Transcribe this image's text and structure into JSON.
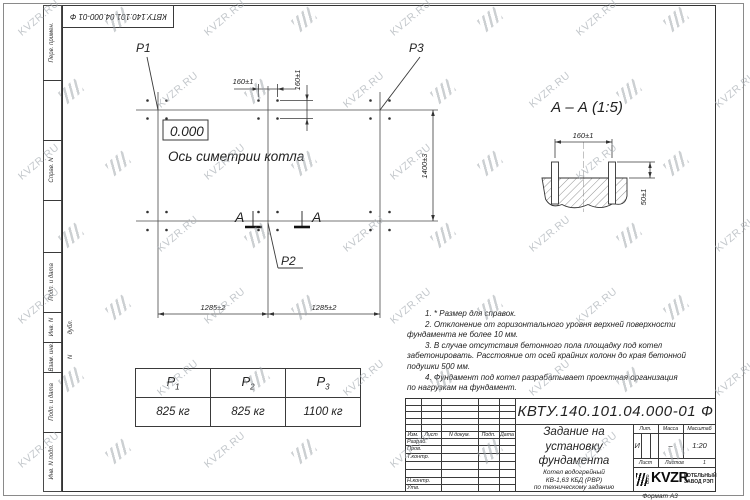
{
  "watermark": {
    "text": "KVZR.RU",
    "color": "#aab0b6"
  },
  "frame": {
    "top_stamp": "КВТУ.140.101.04.000-01 Ф",
    "format_label": "Формат А3",
    "margin_labels": [
      "Перв. примен.",
      "Справ. N",
      "Подп. и дата",
      "Инв. N дубл.",
      "Взам. инв. N",
      "Подп. и дата",
      "Инв. N подл."
    ]
  },
  "plan": {
    "label_p1": "P1",
    "label_p2": "P2",
    "label_p3": "P3",
    "elevation": "0.000",
    "axis_label": "Ось симетрии котла",
    "section_letter_left": "А",
    "section_letter_right": "А",
    "dim_bolt_h": "160±1",
    "dim_bolt_v": "160±1",
    "dim_width": "1400±3",
    "dim_span_left": "1285±2",
    "dim_span_right": "1285±2"
  },
  "section_view": {
    "title": "А – А (1:5)",
    "dim_bolts": "160±1",
    "dim_height": "50±1"
  },
  "notes": {
    "line1": "1. * Размер для справок.",
    "line2": "2. Отклонение от горизонтального уровня верхней поверхности",
    "line3": "фундамента не более 10 мм.",
    "line4": "3. В случае отсутствия бетонного пола площадку под котел",
    "line5": "забетонировать. Расстояние от осей крайних колонн до края бетонной",
    "line6": "подушки 500 мм.",
    "line7": "4. Фундамент под котел разрабатывает проектная организация",
    "line8": "по нагрузкам на фундамент."
  },
  "load_table": {
    "headers": [
      {
        "base": "P",
        "sub": "1"
      },
      {
        "base": "P",
        "sub": "2"
      },
      {
        "base": "P",
        "sub": "3"
      }
    ],
    "values": [
      "825 кг",
      "825 кг",
      "1100 кг"
    ]
  },
  "title_block": {
    "doc_number": "КВТУ.140.101.04.000-01 Ф",
    "title_line1": "Задание на",
    "title_line2": "установку",
    "title_line3": "фундамента",
    "product_line1": "Котел водогрейный",
    "product_line2": "КВ-1,63 КБД (РВР)",
    "product_line3": "по техническому заданию",
    "col_izm": "Изм.",
    "col_list": "Лист",
    "col_docnum": "N докум.",
    "col_podp": "Подп.",
    "col_data": "Дата",
    "row_razrab": "Разраб.",
    "row_prov": "Пров.",
    "row_tkontr": "Т.контр.",
    "row_nkontr": "Н.контр.",
    "row_utv": "Утв.",
    "lit_header": "Лит.",
    "mass_header": "Масса",
    "scale_header": "Масштаб",
    "lit_value": "И",
    "mass_value": "–",
    "scale_value": "1:20",
    "sheet_label": "Лист",
    "sheets_label": "Листов",
    "sheets_value": "1",
    "company_ooo": "ООО",
    "company_logo": "KVZR",
    "company_line1": "КОТЕЛЬНЫЙ",
    "company_line2": "ЗАВОД РЭП"
  }
}
